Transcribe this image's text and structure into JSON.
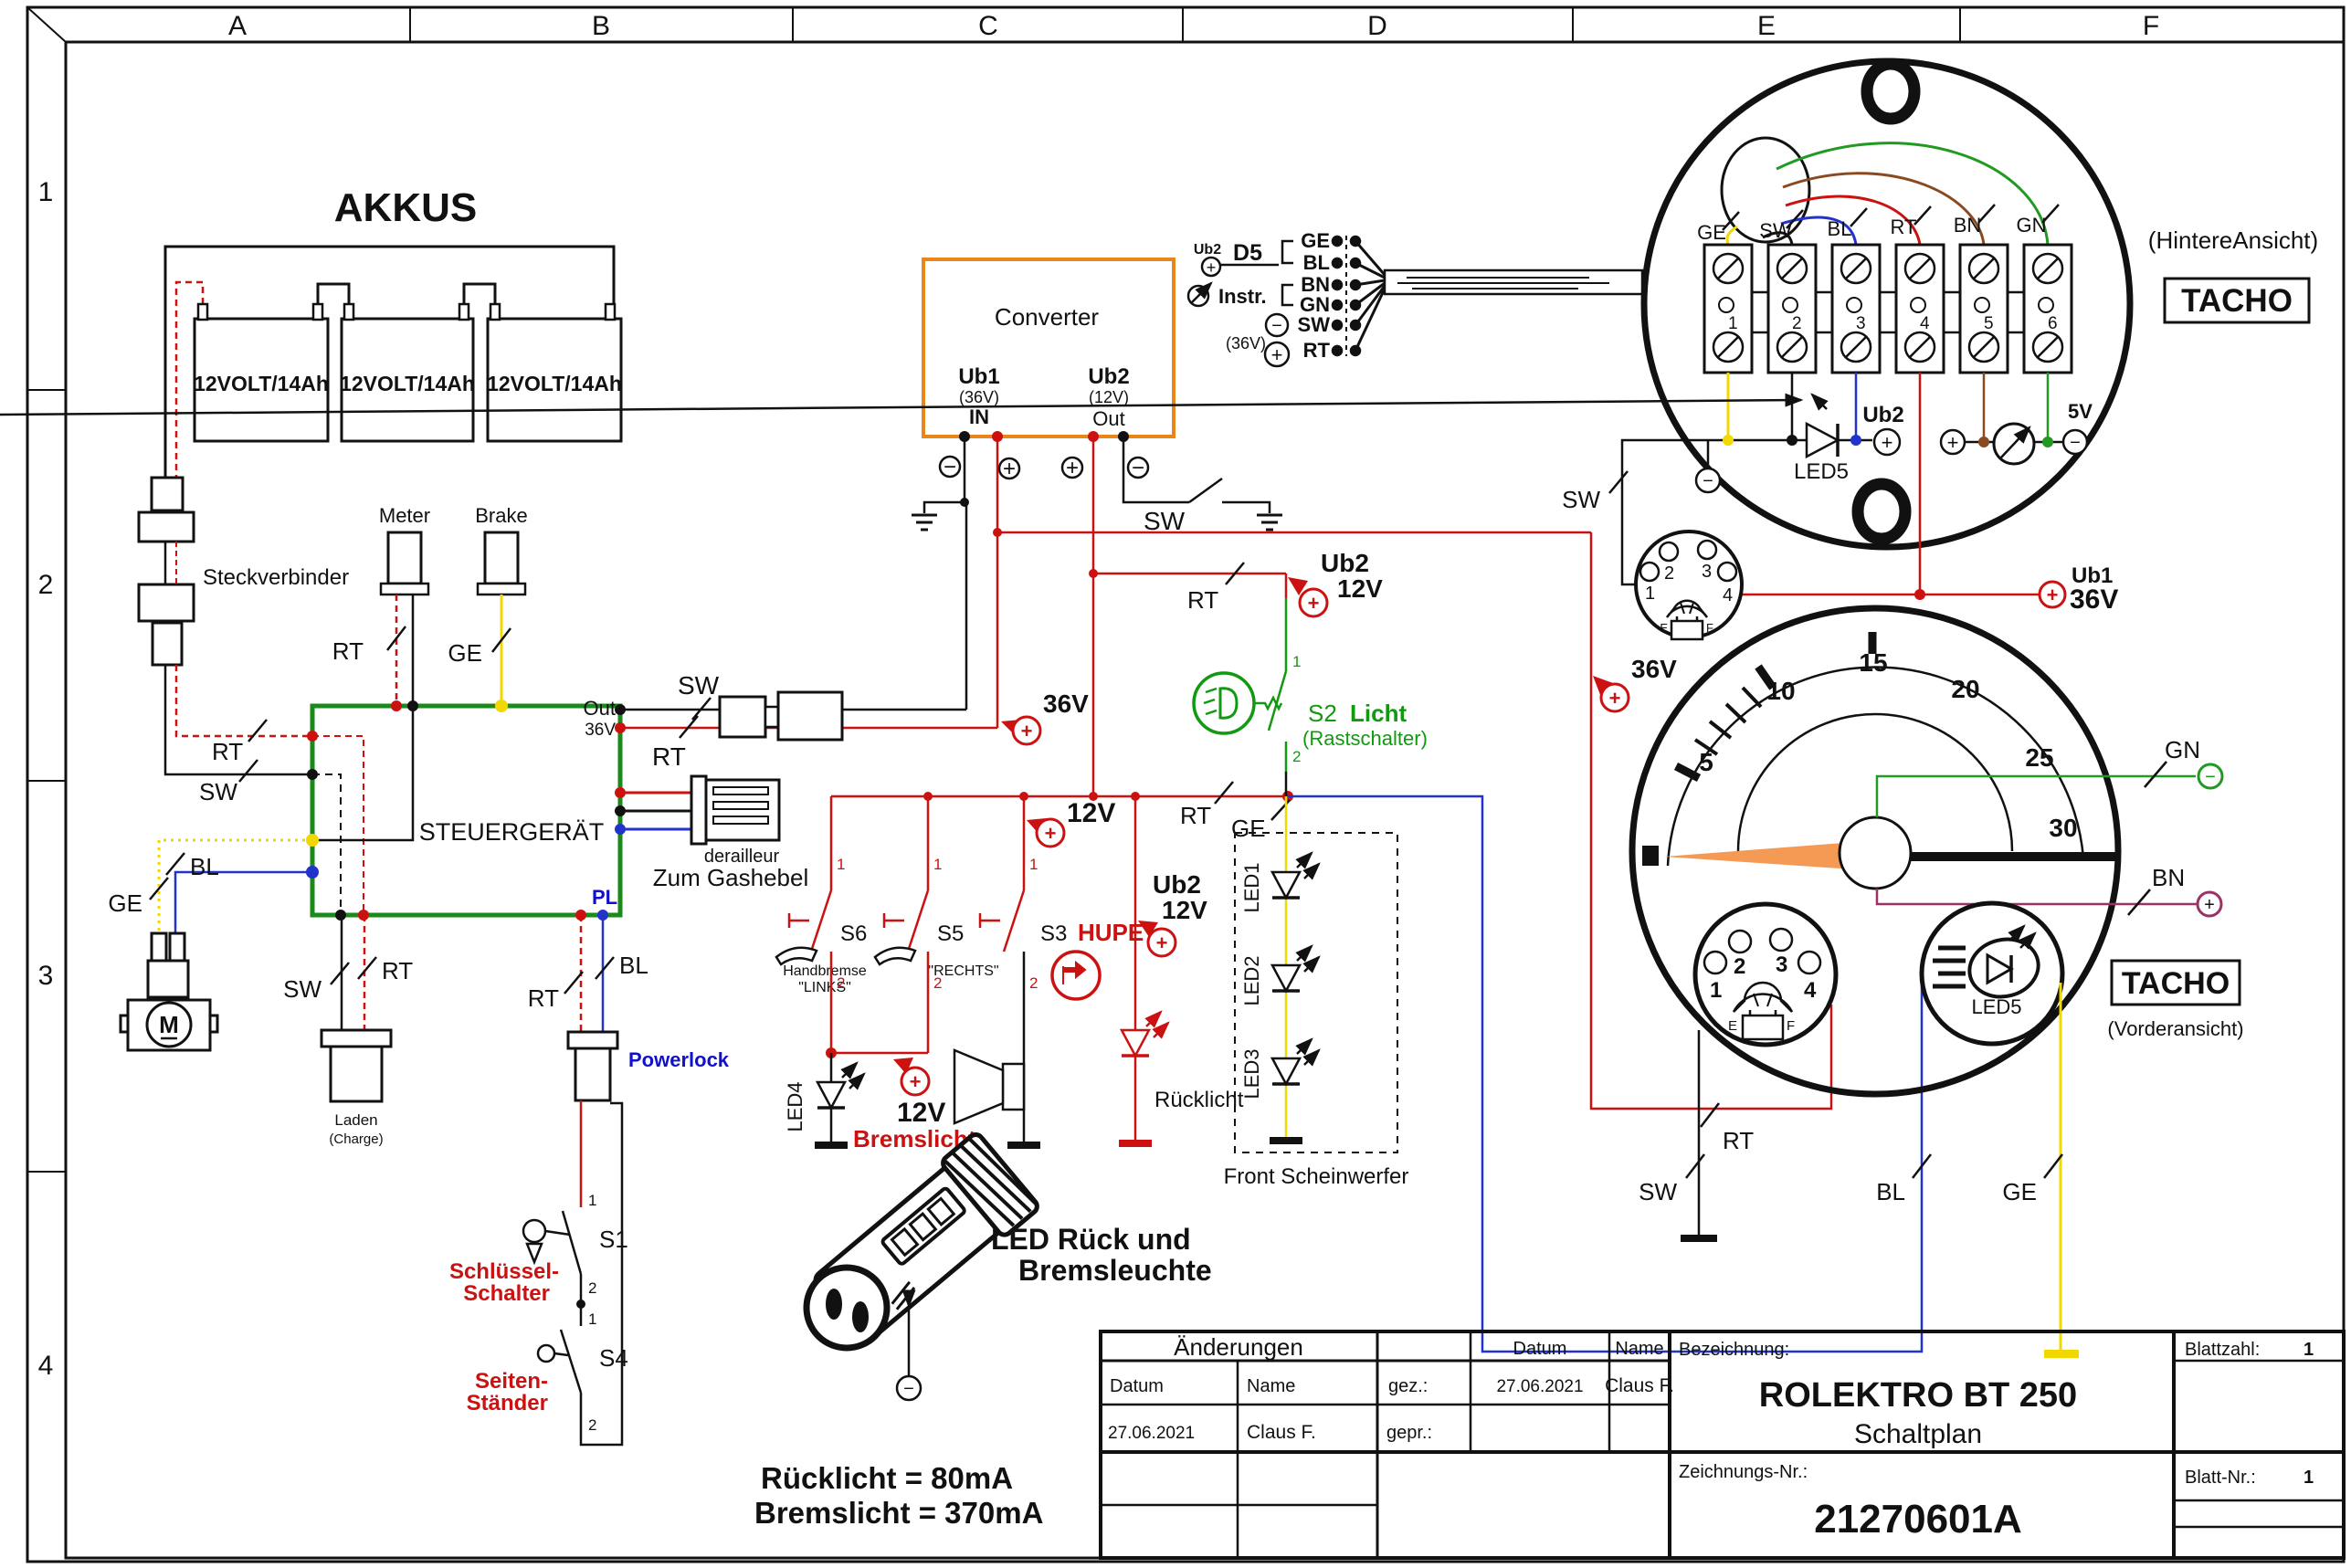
{
  "sheet": {
    "cols": [
      "A",
      "B",
      "C",
      "D",
      "E",
      "F"
    ],
    "rows": [
      "1",
      "2",
      "3",
      "4"
    ]
  },
  "akkus": {
    "title": "AKKUS",
    "battery": "12VOLT/14Ah"
  },
  "wire": {
    "rt": "RT",
    "sw": "SW",
    "ge": "GE",
    "bl": "BL",
    "bn": "BN",
    "gn": "GN",
    "pl": "PL"
  },
  "power": {
    "v36": "36V",
    "v12": "12V",
    "v5": "5V",
    "ub1": "Ub1",
    "ub2": "Ub2",
    "p36": "(36V)",
    "p12": "(12V)",
    "in": "IN",
    "out": "Out"
  },
  "converter": {
    "title": "Converter"
  },
  "controller": {
    "title": "STEUERGERÄT"
  },
  "parts": {
    "steckverbinder": "Steckverbinder",
    "meter": "Meter",
    "brake": "Brake",
    "laden": "Laden",
    "charge": "(Charge)",
    "powerlock": "Powerlock",
    "motor": "M",
    "derailleur": "derailleur",
    "gashebel": "Zum Gashebel",
    "d5": "D5",
    "instr": "Instr."
  },
  "switches": {
    "s1": "S1",
    "s2": "S2",
    "s3": "S3",
    "s4": "S4",
    "s5": "S5",
    "s6": "S6",
    "hupe": "HUPE",
    "licht": "Licht",
    "rast": "(Rastschalter)",
    "schluessel1": "Schlüssel-",
    "schluessel2": "Schalter",
    "seiten1": "Seiten-",
    "seiten2": "Ständer",
    "handbremse": "Handbremse",
    "links": "\"LINKS\"",
    "rechts": "\"RECHTS\"",
    "p1": "1",
    "p2": "2"
  },
  "leds": {
    "led1": "LED1",
    "led2": "LED2",
    "led3": "LED3",
    "led4": "LED4",
    "led5": "LED5",
    "bremslicht": "Bremslicht",
    "ruecklicht": "Rücklicht",
    "front": "Front Scheinwerfer"
  },
  "tacho": {
    "name": "TACHO",
    "rear": "(HintereAnsicht)",
    "front": "(Vorderansicht)",
    "terminals": [
      "1",
      "2",
      "3",
      "4",
      "5",
      "6"
    ],
    "e": "E",
    "f": "F",
    "speeds": [
      "5",
      "10",
      "15",
      "20",
      "25",
      "30"
    ]
  },
  "notes": {
    "l1": "LED Rück und",
    "l2": "Bremsleuchte",
    "m1": "Rücklicht = 80mA",
    "m2": "Bremslicht = 370mA"
  },
  "titleblock": {
    "aenderungen": "Änderungen",
    "datum": "Datum",
    "name": "Name",
    "gez": "gez.:",
    "gepr": "gepr.:",
    "date1": "27.06.2021",
    "name1": "Claus F.",
    "date2": "27.06.2021",
    "name2": "Claus F.",
    "bezeichnung": "Bezeichnung:",
    "title1": "ROLEKTRO BT 250",
    "title2": "Schaltplan",
    "blattzahl": "Blattzahl:",
    "blattzahl_v": "1",
    "blattnr": "Blatt-Nr.:",
    "blattnr_v": "1",
    "znr_label": "Zeichnungs-Nr.:",
    "znr": "21270601A"
  }
}
